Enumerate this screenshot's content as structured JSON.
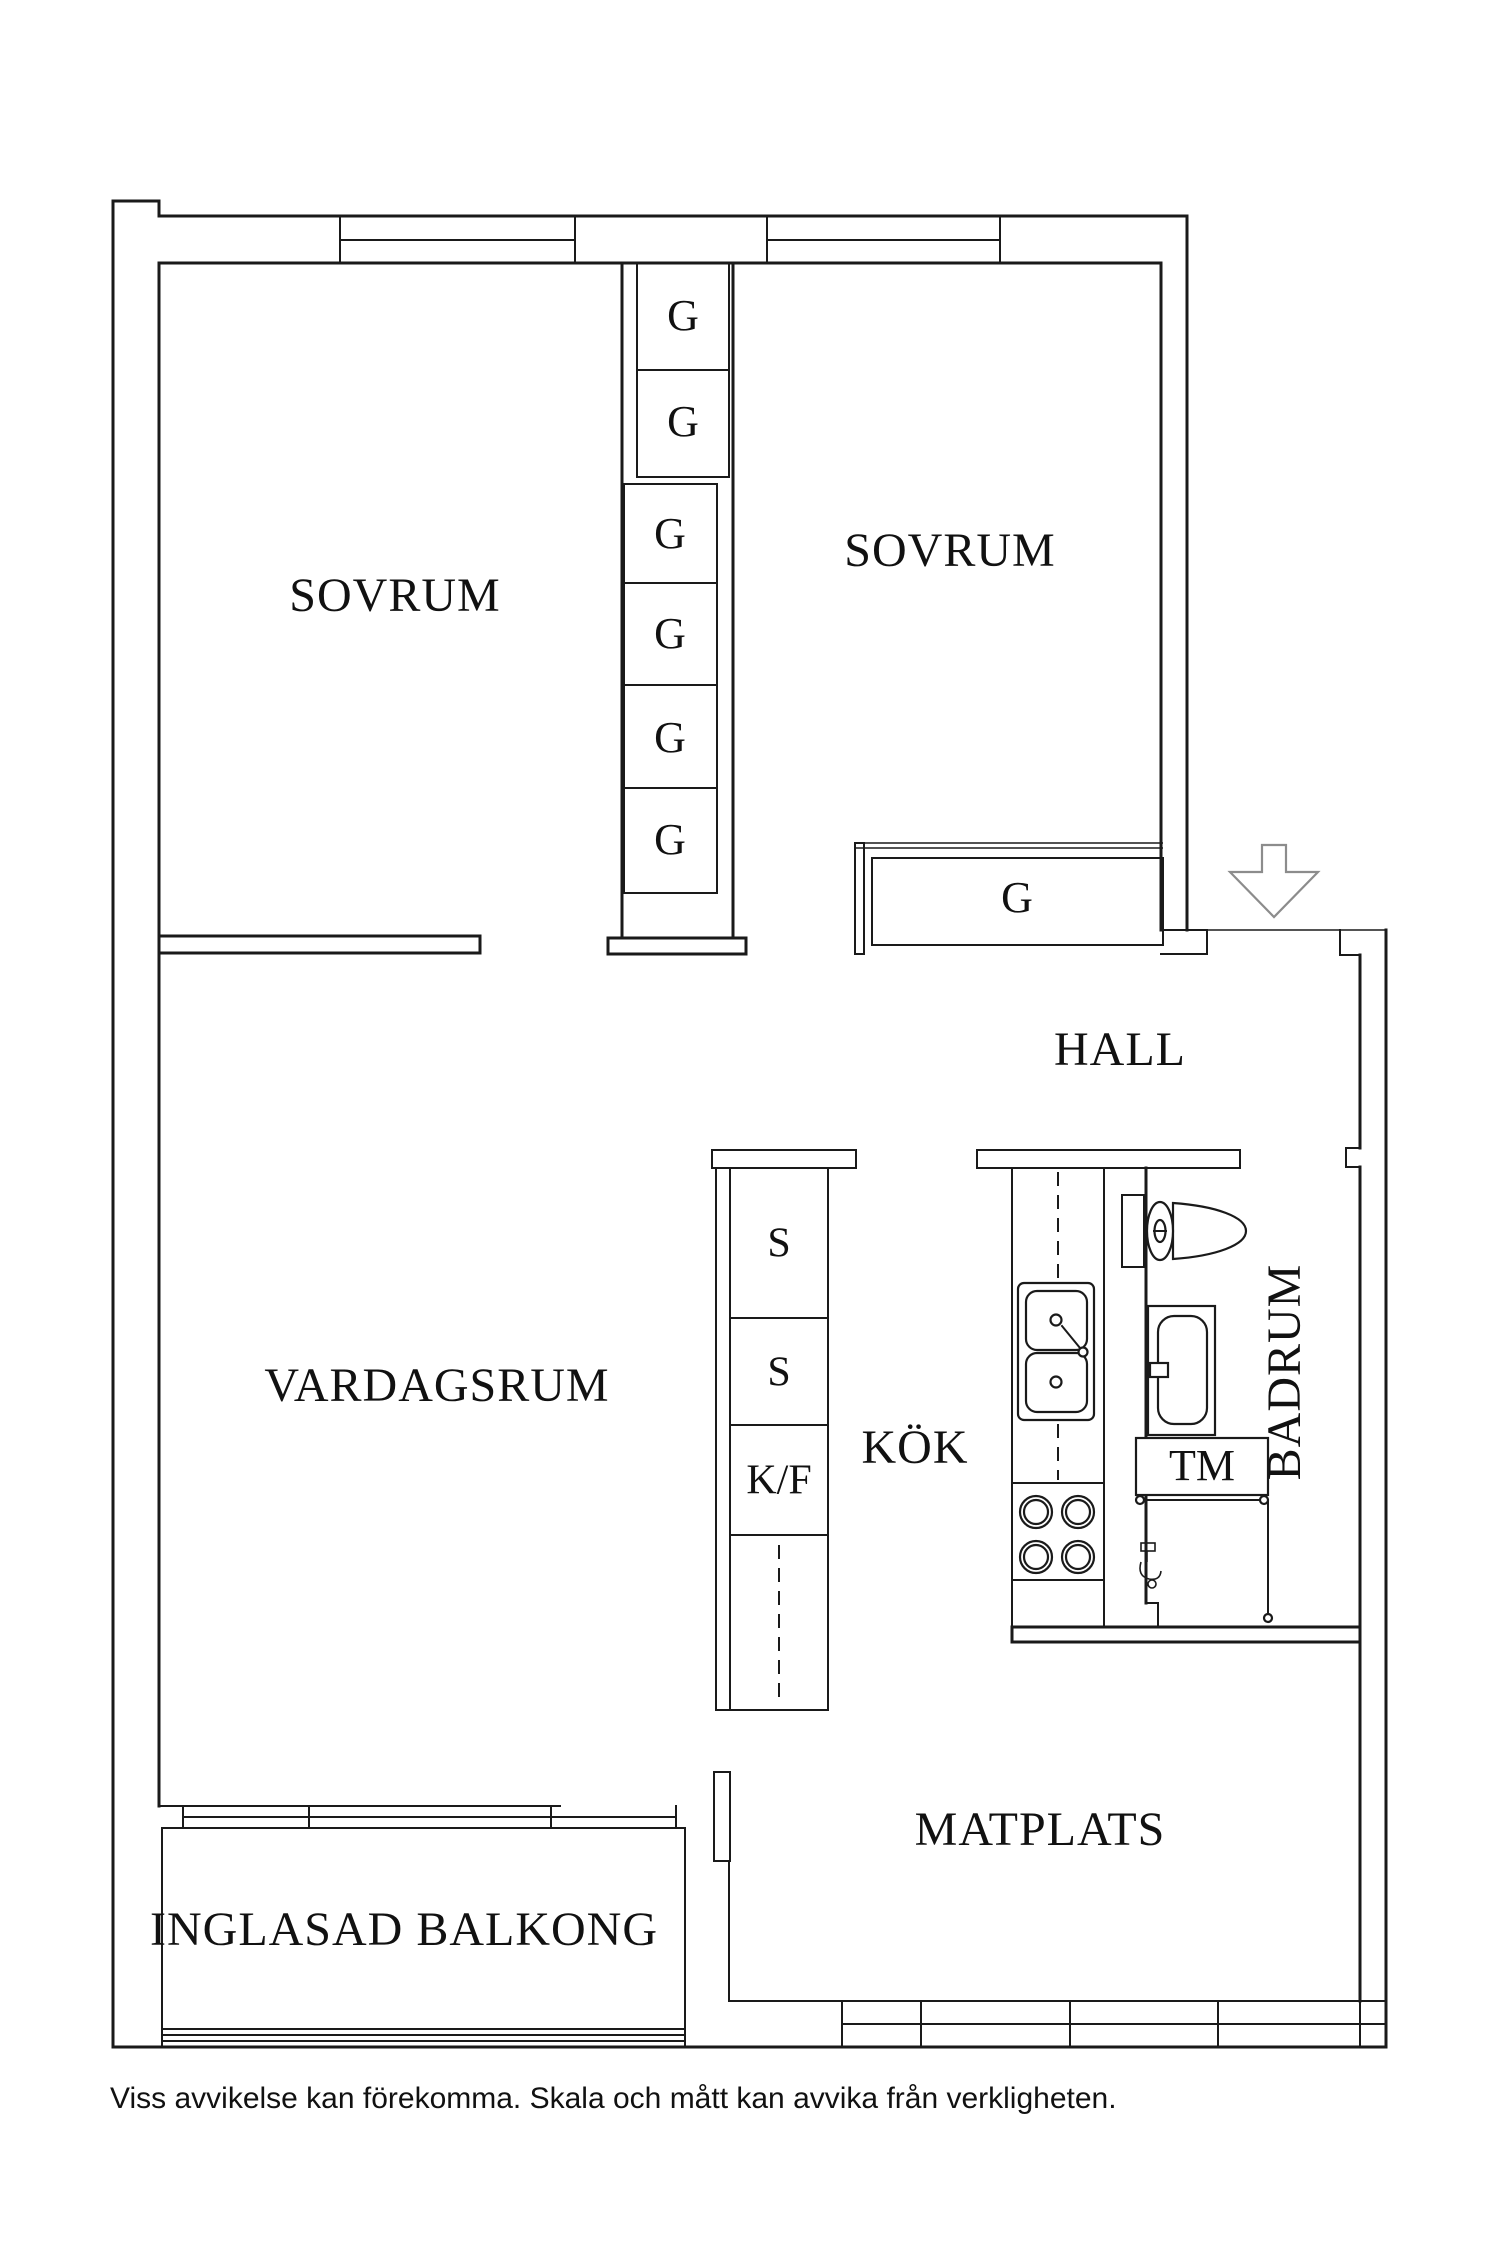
{
  "plan": {
    "labels": {
      "bedroom1": "SOVRUM",
      "bedroom2": "SOVRUM",
      "living_room": "VARDAGSRUM",
      "kitchen": "KÖK",
      "hall": "HALL",
      "bathroom": "BADRUM",
      "dining": "MATPLATS",
      "balcony": "INGLASAD BALKONG",
      "wardrobe": "G",
      "cabinet": "S",
      "fridge_freezer": "K/F",
      "washing_machine": "TM"
    },
    "disclaimer": "Viss avvikelse kan förekomma. Skala och mått kan avvika från verkligheten.",
    "colors": {
      "line": "#1a1a1a",
      "entrance_arrow": "#8c8c8c",
      "background": "#ffffff"
    },
    "icons": [
      "entrance-arrow-icon",
      "toilet-icon",
      "bathroom-sink-icon",
      "kitchen-sink-icon",
      "stove-icon",
      "shower-rail-icon",
      "floor-drain-icon",
      "window-icon"
    ]
  }
}
